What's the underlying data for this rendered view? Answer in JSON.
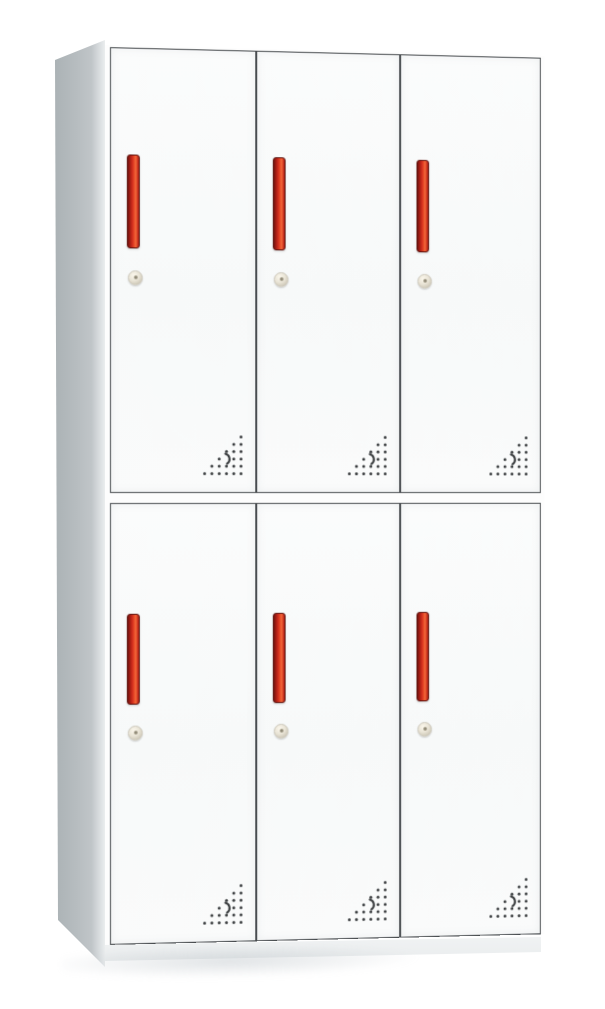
{
  "meta": {
    "type": "product-photo",
    "subject": "6-door steel locker cabinet",
    "description": "White metal locker, 2 rows x 3 columns of doors, each door with a vertical red recessed handle, round cam lock and triangular perforated vent pattern at the bottom-right corner; gray left side panel visible in slight perspective"
  },
  "cabinet": {
    "rows": 2,
    "columns": 3,
    "door_count": 6,
    "features_per_door": [
      "red-handle",
      "cam-lock",
      "vent-holes"
    ]
  },
  "doors": [
    {
      "id": "door-1",
      "row": 1,
      "column": 1
    },
    {
      "id": "door-2",
      "row": 1,
      "column": 2
    },
    {
      "id": "door-3",
      "row": 1,
      "column": 3
    },
    {
      "id": "door-4",
      "row": 2,
      "column": 1
    },
    {
      "id": "door-5",
      "row": 2,
      "column": 2
    },
    {
      "id": "door-6",
      "row": 2,
      "column": 3
    }
  ],
  "vent": {
    "pattern": "right-triangle",
    "rows": 6,
    "max_dots_per_row": 6,
    "dot_color": "#3a3d3f",
    "has_crescent_mark": true,
    "crescent_row": 4,
    "crescent_col": 4
  },
  "colors": {
    "background": "#ffffff",
    "frame_white": "#fdfdfd",
    "door_face": "#f7f9f9",
    "door_outline": "#45494c",
    "side_panel": "#b7bdc0",
    "side_panel_dark": "#abb2b5",
    "side_highlight": "#dde1e3",
    "handle_red": "#ce2c1c",
    "handle_red_dark": "#70140f",
    "handle_red_bright": "#f26b3a",
    "lock_body": "#e9e4d6",
    "lock_edge": "#b9b3a2",
    "vent_dot": "#3a3d3f",
    "plinth": "#f1f3f4"
  }
}
